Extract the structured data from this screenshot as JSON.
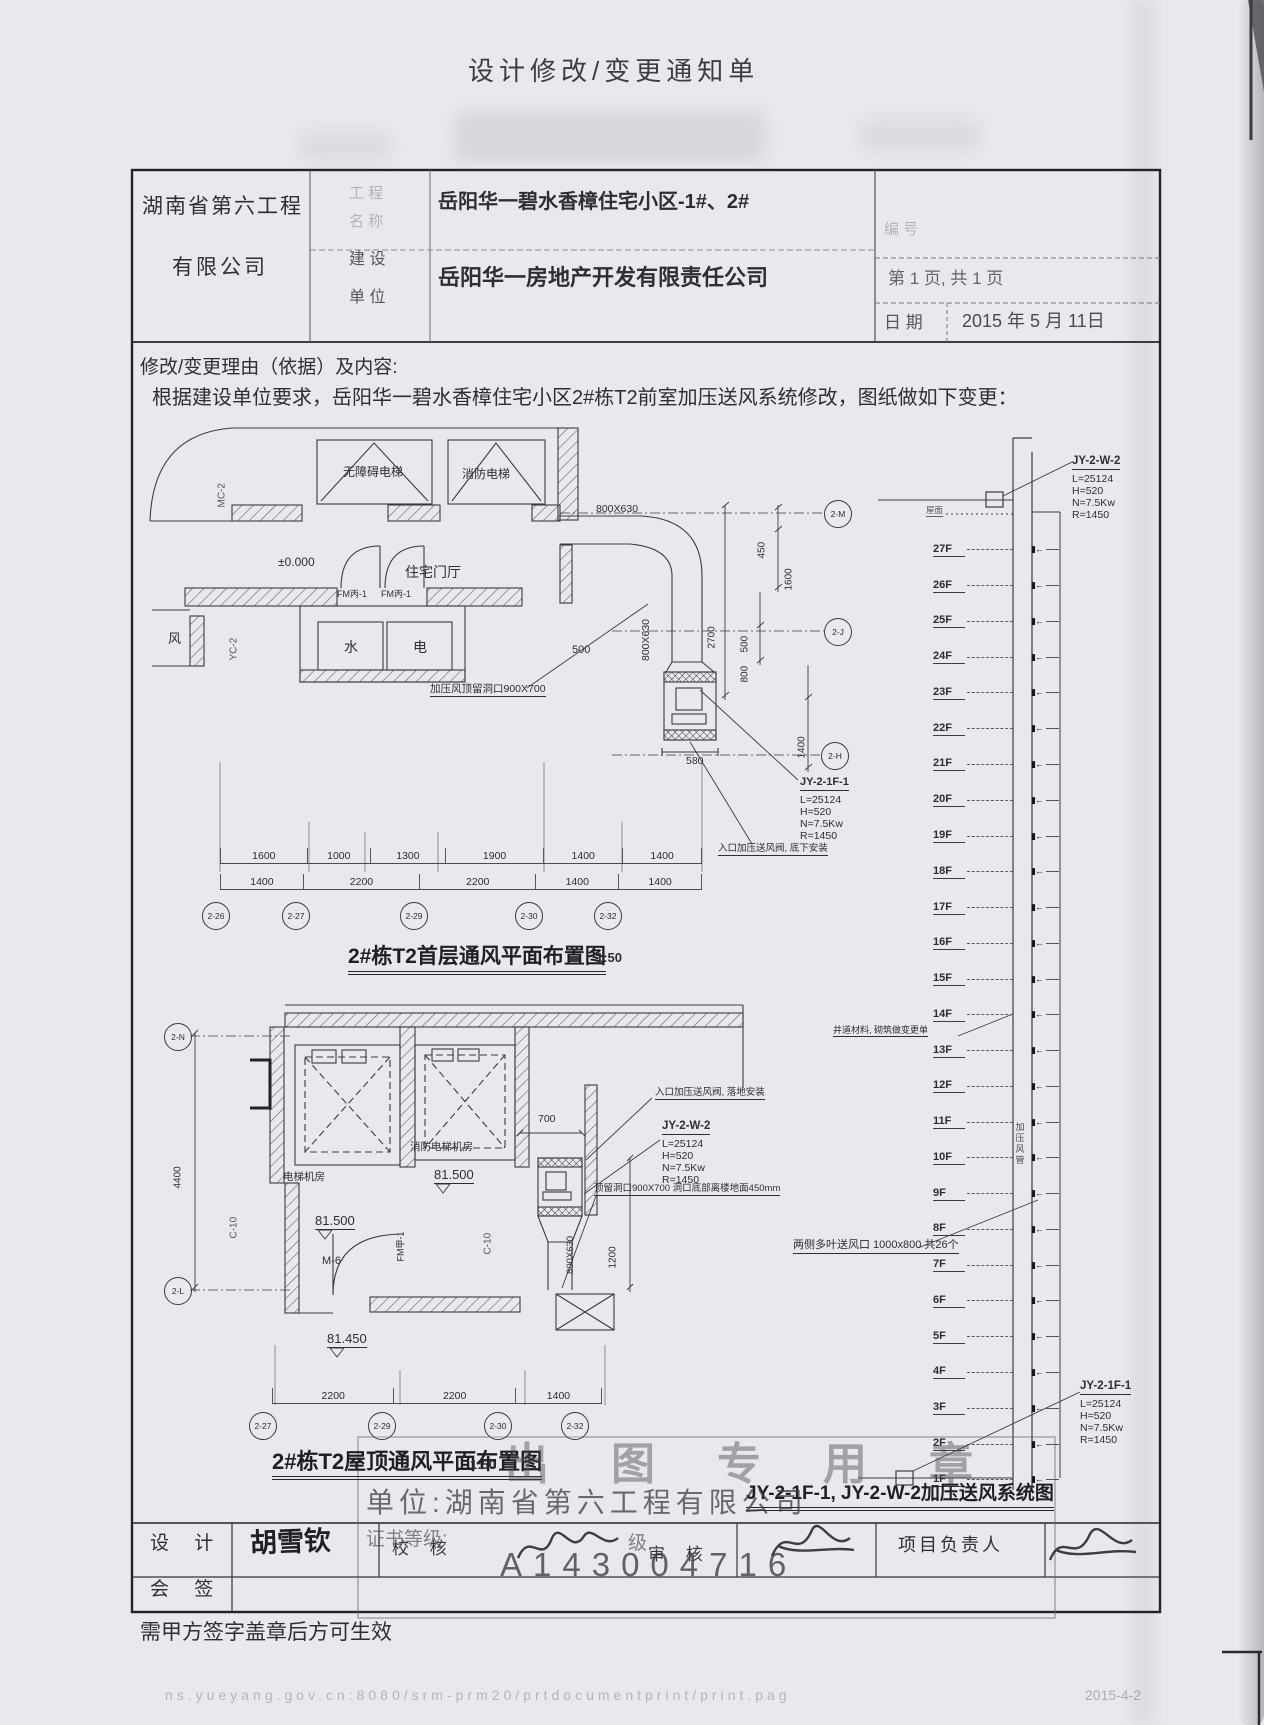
{
  "page": {
    "title": "设计修改/变更通知单",
    "bottom_note": "需甲方签字盖章后方可生效",
    "print_url": "ns.yueyang.gov.cn:8080/srm-prm20/prtdocumentprint/print.pag",
    "print_date": "2015-4-2"
  },
  "header": {
    "company_line1": "湖南省第六工程",
    "company_line2": "有限公司",
    "project_label_top": "工 程",
    "project_label_bottom": "名 称",
    "project_name": "岳阳华一碧水香樟住宅小区-1#、2#",
    "builder_label_top": "建 设",
    "builder_label_bottom": "单 位",
    "builder_name": "岳阳华一房地产开发有限责任公司",
    "doc_no_label": "编  号",
    "page_info": "第  1  页, 共  1  页",
    "date_label": "日  期",
    "date_value": "2015 年 5 月 11日"
  },
  "reason": {
    "label": "修改/变更理由（依据）及内容:",
    "content": "根据建设单位要求，岳阳华一碧水香樟住宅小区2#栋T2前室加压送风系统修改，图纸做如下变更："
  },
  "plan1": {
    "caption": "2#栋T2首层通风平面布置图",
    "scale": "1:50",
    "labels": {
      "mc2": "MC-2",
      "elevator1": "无障碍电梯",
      "elevator2": "消防电梯",
      "level": "±0.000",
      "lobby": "住宅门厅",
      "door1": "FM丙-1",
      "door2": "FM丙-1",
      "wind": "风",
      "yc2": "YC-2",
      "water": "水",
      "power": "电",
      "hole_note": "加压风顶留洞口900X700",
      "duct_h": "800X630",
      "duct_v": "800X630",
      "dim500": "500",
      "dim580": "580",
      "valve_note": "入口加压送风阀, 底下安装"
    },
    "rdims": {
      "d450": "450",
      "d1600": "1600",
      "d500": "500",
      "d800": "800",
      "d1400": "1400",
      "d2700": "2700"
    },
    "fan": {
      "name": "JY-2-1F-1",
      "l": "L=25124",
      "h": "H=520",
      "n": "N=7.5Kw",
      "r": "R=1450"
    },
    "dims_row1": [
      {
        "v": 1600
      },
      {
        "v": 1000
      },
      {
        "v": 1300
      },
      {
        "v": 1900
      },
      {
        "v": 1400
      },
      {
        "v": 1400
      }
    ],
    "dims_row2": [
      {
        "v": 1400
      },
      {
        "v": 2200
      },
      {
        "v": 2200
      },
      {
        "v": 1400
      },
      {
        "v": 1400
      }
    ],
    "grid_cols": [
      "2-26",
      "2-27",
      "2-29",
      "2-30",
      "2-32"
    ],
    "grid_rows": [
      "2-M",
      "2-J",
      "2-H"
    ]
  },
  "riser": {
    "caption": "JY-2-1F-1, JY-2-W-2加压送风系统图",
    "roof_label": "屋面",
    "floors": [
      "27F",
      "26F",
      "25F",
      "24F",
      "23F",
      "22F",
      "21F",
      "20F",
      "19F",
      "18F",
      "17F",
      "16F",
      "15F",
      "14F",
      "13F",
      "12F",
      "11F",
      "10F",
      "9F",
      "8F",
      "7F",
      "6F",
      "5F",
      "4F",
      "3F",
      "2F",
      "1F"
    ],
    "fan_top": {
      "name": "JY-2-W-2",
      "l": "L=25124",
      "h": "H=520",
      "n": "N=7.5Kw",
      "r": "R=1450"
    },
    "fan_bottom": {
      "name": "JY-2-1F-1",
      "l": "L=25124",
      "h": "H=520",
      "n": "N=7.5Kw",
      "r": "R=1450"
    },
    "note_shaft": "井道材料, 砌筑做变更单",
    "note_louver": "两侧多叶送风口 1000x800 共26个",
    "duct_label": "加压风管"
  },
  "plan2": {
    "caption": "2#栋T2屋顶通风平面布置图",
    "scale": "1:50",
    "labels": {
      "machine_room1": "电梯机房",
      "machine_room2": "消防电梯机房",
      "level1": "81.500",
      "level2": "81.500",
      "level3": "81.450",
      "door": "M-6",
      "c10a": "C-10",
      "c10b": "C-10",
      "fm": "FM甲-1",
      "dim4400": "4400",
      "dim700": "700",
      "dim1200": "1200",
      "duct_v": "800X630",
      "valve_note": "入口加压送风阀, 落地安装",
      "hole_note": "顶留洞口900X700 洞口底部离楼地面450mm"
    },
    "fan": {
      "name": "JY-2-W-2",
      "l": "L=25124",
      "h": "H=520",
      "n": "N=7.5Kw",
      "r": "R=1450"
    },
    "dims_bottom": [
      {
        "v": 2200
      },
      {
        "v": 2200
      },
      {
        "v": 1400
      }
    ],
    "grid_cols": [
      "2-27",
      "2-29",
      "2-30",
      "2-32"
    ],
    "grid_rows": [
      "2-N",
      "2-L"
    ]
  },
  "stamp": {
    "big_text": "出图专用章",
    "unit_line": "单位:湖南省第六工程有限公司",
    "grade_label": "证书等级:",
    "grade_suffix": "级",
    "number": "A143004716"
  },
  "signatures": {
    "design_label": "设 计",
    "designer": "胡雪钦",
    "check_label": "校 核",
    "review_label": "审 核",
    "pm_label": "项目负责人",
    "cosign_label": "会 签"
  }
}
